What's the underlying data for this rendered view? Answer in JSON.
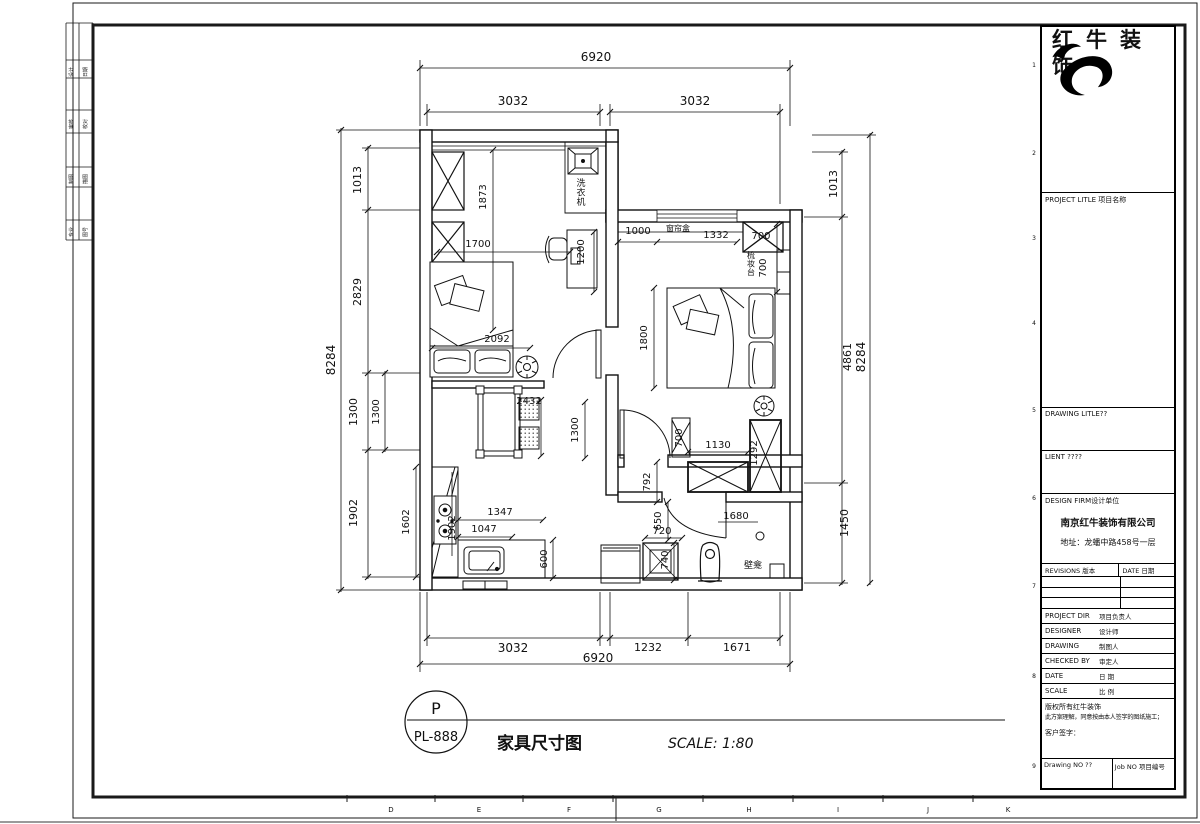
{
  "page": {
    "grid_letters": [
      {
        "t": "D",
        "x": 391
      },
      {
        "t": "E",
        "x": 479
      },
      {
        "t": "F",
        "x": 569
      },
      {
        "t": "G",
        "x": 659
      },
      {
        "t": "H",
        "x": 749
      },
      {
        "t": "I",
        "x": 838
      },
      {
        "t": "J",
        "x": 928
      },
      {
        "t": "K",
        "x": 1008
      }
    ],
    "grid_numbers": [
      {
        "t": "1",
        "y": 67
      },
      {
        "t": "2",
        "y": 155
      },
      {
        "t": "3",
        "y": 240
      },
      {
        "t": "4",
        "y": 325
      },
      {
        "t": "5",
        "y": 412
      },
      {
        "t": "6",
        "y": 500
      },
      {
        "t": "7",
        "y": 588
      },
      {
        "t": "8",
        "y": 678
      },
      {
        "t": "9",
        "y": 768
      }
    ],
    "stamp_cells": [
      {
        "t": "设计",
        "x": 73,
        "y": 72
      },
      {
        "t": "日期",
        "x": 87,
        "y": 72
      },
      {
        "t": "审核",
        "x": 73,
        "y": 124
      },
      {
        "t": "校对",
        "x": 87,
        "y": 124
      },
      {
        "t": "制图",
        "x": 73,
        "y": 179
      },
      {
        "t": "描图",
        "x": 87,
        "y": 179
      },
      {
        "t": "专业",
        "x": 73,
        "y": 232
      },
      {
        "t": "图号",
        "x": 87,
        "y": 232
      }
    ]
  },
  "title_block": {
    "company_name": "红牛装饰",
    "project_title_label": "PROJECT LITLE 项目名称",
    "drawing_title_label": "DRAWING LITLE??",
    "client_label": "LIENT ????",
    "design_firm_label": "DESIGN FIRM设计单位",
    "firm_name": "南京红牛装饰有限公司",
    "firm_address": "地址：龙蟠中路458号一层",
    "revisions_label": "REVISIONS 版本",
    "date_col_label": "DATE 日期",
    "rows": [
      {
        "en": "PROJECT DIR",
        "cn": "项目负责人"
      },
      {
        "en": "DESIGNER",
        "cn": "设计师"
      },
      {
        "en": "DRAWING",
        "cn": "制图人"
      },
      {
        "en": "CHECKED BY",
        "cn": "审定人"
      },
      {
        "en": "DATE",
        "cn": "日 期"
      },
      {
        "en": "SCALE",
        "cn": "比 例"
      }
    ],
    "copyright_line1": "版权所有红牛装饰",
    "copyright_line2": "此方案理解，同意按由本人签字的图纸施工；",
    "client_sign_label": "客户签字：",
    "drawing_no_label": "Drawing NO ??",
    "job_no_label": "Job NO 项目编号"
  },
  "texts": [
    {
      "t": "6920",
      "x": 596,
      "y": 61,
      "s": 12
    },
    {
      "t": "3032",
      "x": 513,
      "y": 105,
      "s": 12
    },
    {
      "t": "3032",
      "x": 695,
      "y": 105,
      "s": 12
    },
    {
      "t": "8284",
      "x": 335,
      "y": 360,
      "s": 12,
      "r": -90
    },
    {
      "t": "1013",
      "x": 361,
      "y": 180,
      "s": 11,
      "r": -90
    },
    {
      "t": "2829",
      "x": 361,
      "y": 292,
      "s": 11,
      "r": -90
    },
    {
      "t": "1300",
      "x": 357,
      "y": 412,
      "s": 11,
      "r": -90
    },
    {
      "t": "1300",
      "x": 379,
      "y": 412,
      "s": 10,
      "r": -90
    },
    {
      "t": "1902",
      "x": 357,
      "y": 513,
      "s": 11,
      "r": -90
    },
    {
      "t": "1013",
      "x": 837,
      "y": 184,
      "s": 11,
      "r": -90
    },
    {
      "t": "4861",
      "x": 851,
      "y": 357,
      "s": 11,
      "r": -90
    },
    {
      "t": "8284",
      "x": 865,
      "y": 357,
      "s": 12,
      "r": -90
    },
    {
      "t": "1450",
      "x": 848,
      "y": 523,
      "s": 11,
      "r": -90
    },
    {
      "t": "3032",
      "x": 513,
      "y": 652,
      "s": 12
    },
    {
      "t": "1232",
      "x": 648,
      "y": 651,
      "s": 11
    },
    {
      "t": "1671",
      "x": 737,
      "y": 651,
      "s": 11
    },
    {
      "t": "6920",
      "x": 598,
      "y": 662,
      "s": 12
    },
    {
      "t": "1873",
      "x": 486,
      "y": 197,
      "s": 10,
      "r": -90
    },
    {
      "t": "1700",
      "x": 478,
      "y": 247,
      "s": 10
    },
    {
      "t": "1200",
      "x": 584,
      "y": 252,
      "s": 10,
      "r": -90
    },
    {
      "t": "洗衣机",
      "x": 581,
      "y": 186,
      "s": 9,
      "v": 1,
      "n": "label-washing-machine"
    },
    {
      "t": "2092",
      "x": 497,
      "y": 342,
      "s": 10
    },
    {
      "t": "1000",
      "x": 638,
      "y": 234,
      "s": 10
    },
    {
      "t": "窗帘盒",
      "x": 678,
      "y": 231,
      "s": 8,
      "n": "label-curtain-box"
    },
    {
      "t": "1332",
      "x": 716,
      "y": 238,
      "s": 10
    },
    {
      "t": "700",
      "x": 761,
      "y": 239,
      "s": 10
    },
    {
      "t": "梳妆台",
      "x": 751,
      "y": 258,
      "s": 8,
      "v": 1,
      "n": "label-dressing-table"
    },
    {
      "t": "700",
      "x": 766,
      "y": 268,
      "s": 10,
      "r": -90
    },
    {
      "t": "1800",
      "x": 647,
      "y": 338,
      "s": 10,
      "r": -90
    },
    {
      "t": "2432",
      "x": 529,
      "y": 404,
      "s": 10
    },
    {
      "t": "1300",
      "x": 578,
      "y": 430,
      "s": 10,
      "r": -90
    },
    {
      "t": "700",
      "x": 682,
      "y": 438,
      "s": 10,
      "r": -90
    },
    {
      "t": "1130",
      "x": 718,
      "y": 448,
      "s": 10
    },
    {
      "t": "1292",
      "x": 757,
      "y": 453,
      "s": 10,
      "r": -90
    },
    {
      "t": "792",
      "x": 650,
      "y": 482,
      "s": 10,
      "r": -90
    },
    {
      "t": "650",
      "x": 661,
      "y": 521,
      "s": 10,
      "r": -90
    },
    {
      "t": "720",
      "x": 662,
      "y": 534,
      "s": 10
    },
    {
      "t": "740",
      "x": 668,
      "y": 560,
      "s": 10,
      "r": -90
    },
    {
      "t": "1680",
      "x": 736,
      "y": 519,
      "s": 10
    },
    {
      "t": "壁龛",
      "x": 753,
      "y": 568,
      "s": 9,
      "n": "label-wall-niche"
    },
    {
      "t": "1602",
      "x": 409,
      "y": 522,
      "s": 10,
      "r": -90
    },
    {
      "t": "1902",
      "x": 455,
      "y": 528,
      "s": 10,
      "r": -90
    },
    {
      "t": "1347",
      "x": 500,
      "y": 515,
      "s": 10
    },
    {
      "t": "1047",
      "x": 484,
      "y": 532,
      "s": 10
    },
    {
      "t": "600",
      "x": 547,
      "y": 559,
      "s": 10,
      "r": -90
    },
    {
      "t": "P",
      "x": 436,
      "y": 714,
      "s": 16,
      "n": "detail-ref-letter"
    },
    {
      "t": "PL-888",
      "x": 436,
      "y": 741,
      "s": 13,
      "n": "detail-ref-number"
    },
    {
      "t": "家具尺寸图",
      "x": 497,
      "y": 749,
      "s": 17,
      "b": 1,
      "a": "start",
      "n": "drawing-title"
    },
    {
      "t": "SCALE: 1:80",
      "x": 668,
      "y": 748,
      "s": 14,
      "i": 1,
      "a": "start",
      "n": "scale-label"
    }
  ]
}
